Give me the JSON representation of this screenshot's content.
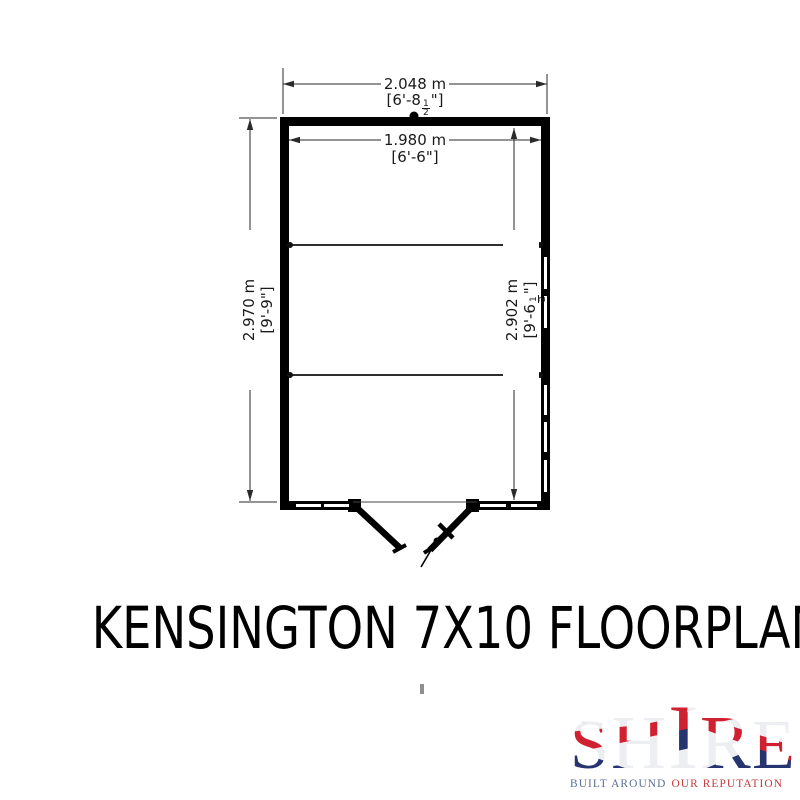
{
  "title": "KENSINGTON 7X10 FLOORPLAN",
  "floorplan": {
    "dimensions": {
      "top_outer": {
        "metric": "2.048 m",
        "imperial_pre": "[6'-8",
        "frac_num": "1",
        "frac_den": "2",
        "imperial_post": "\"]"
      },
      "top_inner": {
        "metric": "1.980 m",
        "imperial": "[6'-6\"]"
      },
      "left": {
        "metric": "2.970 m",
        "imperial": "[9'-9\"]"
      },
      "right_inner": {
        "metric": "2.902 m",
        "imperial_pre": "[9'-6",
        "frac_num": "1",
        "frac_den": "2",
        "imperial_post": "\"]"
      }
    },
    "features": [
      "double-door",
      "windows-right-wall",
      "windows-front-wall"
    ]
  },
  "logo": {
    "name": "SHIRE",
    "letters": [
      "S",
      "H",
      "I",
      "R",
      "E"
    ],
    "tagline_left": "BUILT AROUND",
    "tagline_right": "OUR REPUTATION",
    "colors": {
      "flag_red": "#cf2130",
      "flag_blue": "#26356f",
      "tagline_blue": "#5a6e97",
      "tagline_red": "#c43a3c"
    }
  }
}
